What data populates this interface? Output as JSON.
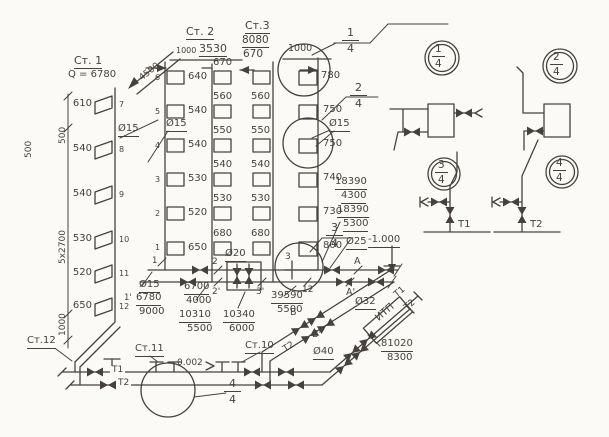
{
  "palette": {
    "ink": "#46423b",
    "paper": "#fbfaf7"
  },
  "risers": {
    "st1": {
      "label": "Ст. 1",
      "q": "Q = 6780",
      "diag_dim": "4500",
      "dia": "Ø15",
      "values": [
        "610",
        "540",
        "540",
        "530",
        "520",
        "650"
      ],
      "nodes": [
        "7",
        "8",
        "9",
        "10",
        "11",
        "12"
      ],
      "node_prime": "1'",
      "dims": {
        "h500": "500",
        "h500_left": "500",
        "floors": "5x2700",
        "base": "1000"
      }
    },
    "st2": {
      "label": "Ст. 2",
      "dim_offset": "1000",
      "dim_height": "3530",
      "dia": "Ø15",
      "left_values": [
        "640",
        "540",
        "540",
        "530",
        "520",
        "650"
      ],
      "right_values": [
        "670",
        "560",
        "550",
        "540",
        "530",
        "680"
      ],
      "nodes": [
        "6",
        "5",
        "4",
        "3",
        "2",
        "1"
      ]
    },
    "st3": {
      "label": "Ст.3",
      "dim_height": "8080",
      "dim_top": "1000",
      "dia": "Ø15",
      "left_values": [
        "670",
        "560",
        "550",
        "540",
        "530",
        "680"
      ],
      "right_values": [
        "780",
        "750",
        "750",
        "740",
        "730",
        "800"
      ]
    },
    "st10": {
      "label": "Ст.10"
    },
    "st11": {
      "label": "Ст.11"
    },
    "st12": {
      "label": "Ст.12"
    }
  },
  "mains": {
    "t1": "Т1",
    "t2": "Т2",
    "t1_diag": "Т1",
    "t2_diag": "Т2",
    "t2_branch": "Т2",
    "slope": "0.002",
    "elevation": "-1.000",
    "itp": "ИТП",
    "dia15": "Ø15",
    "dia20": "Ø20",
    "dia25": "Ø25",
    "dia32": "Ø32",
    "dia40": "Ø40",
    "nodes": {
      "n1": "1",
      "n2": "2",
      "n2p": "2'",
      "n3": "3",
      "n3p": "3'",
      "n12": "12",
      "a": "A",
      "ap": "A'",
      "b": "B",
      "bp": "B'"
    }
  },
  "flows": {
    "f1": {
      "top": "6780",
      "bot": "9000"
    },
    "f2": {
      "top": "6700",
      "bot": "4000"
    },
    "f3": {
      "top": "10310",
      "bot": "5500"
    },
    "f4": {
      "top": "10340",
      "bot": "6000"
    },
    "f5": {
      "top": "39590",
      "bot": "5500"
    },
    "f6": {
      "top": "18390",
      "bot": "4300"
    },
    "f7": {
      "top": "18390",
      "bot": "5300"
    },
    "f8": {
      "top": "81020",
      "bot": "8300"
    }
  },
  "callouts": {
    "c1": {
      "num": "1",
      "den": "4"
    },
    "c2": {
      "num": "2",
      "den": "4"
    },
    "c3": {
      "num": "3",
      "den": "4"
    },
    "c4": {
      "num": "4",
      "den": "4"
    }
  },
  "details": {
    "d1": {
      "num": "1",
      "den": "4"
    },
    "d2": {
      "num": "2",
      "den": "4"
    },
    "d3": {
      "num": "3",
      "den": "4",
      "pipe": "Т1"
    },
    "d4": {
      "num": "4",
      "den": "4",
      "pipe": "Т2"
    }
  }
}
